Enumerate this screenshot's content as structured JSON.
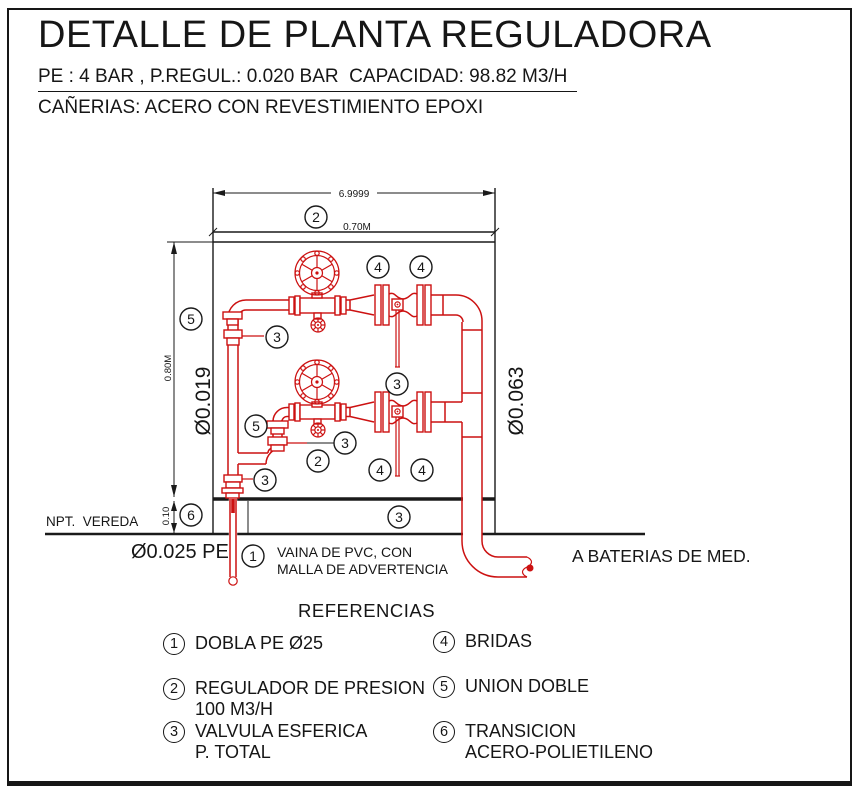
{
  "header": {
    "title": "DETALLE DE PLANTA REGULADORA",
    "spec_line": "PE : 4 BAR , P.REGUL.: 0.020 BAR  CAPACIDAD: 98.82 M3/H",
    "material_line": "CAÑERIAS: ACERO CON REVESTIMIENTO EPOXI"
  },
  "drawing": {
    "dimensions": {
      "overall_width": "6.9999",
      "inner_width": "0.70M",
      "inner_height": "0.80M",
      "slab_thickness": "0.10",
      "inlet_pipe_diameter": "Ø0.019",
      "outlet_pipe_diameter": "Ø0.063",
      "buried_pipe": "Ø0.025 PE"
    },
    "annotations": {
      "ground_level": "NPT.  VEREDA",
      "sleeve_note_line1": "VAINA DE PVC, CON",
      "sleeve_note_line2": "MALLA DE ADVERTENCIA",
      "outlet_destination": "A BATERIAS DE MED."
    },
    "callouts": [
      "2",
      "4",
      "4",
      "5",
      "3",
      "3",
      "5",
      "3",
      "2",
      "4",
      "4",
      "3",
      "6",
      "3",
      "1"
    ]
  },
  "references": {
    "heading": "REFERENCIAS",
    "items": [
      {
        "n": "1",
        "lines": [
          "DOBLA PE Ø25"
        ]
      },
      {
        "n": "2",
        "lines": [
          "REGULADOR DE PRESION",
          "100 M3/H"
        ]
      },
      {
        "n": "3",
        "lines": [
          "VALVULA ESFERICA",
          "P. TOTAL"
        ]
      },
      {
        "n": "4",
        "lines": [
          "BRIDAS"
        ]
      },
      {
        "n": "5",
        "lines": [
          "UNION DOBLE"
        ]
      },
      {
        "n": "6",
        "lines": [
          "TRANSICION",
          "ACERO-POLIETILENO"
        ]
      }
    ]
  },
  "colors": {
    "piping_red": "#cc1111",
    "linework_black": "#1a1a1a"
  }
}
